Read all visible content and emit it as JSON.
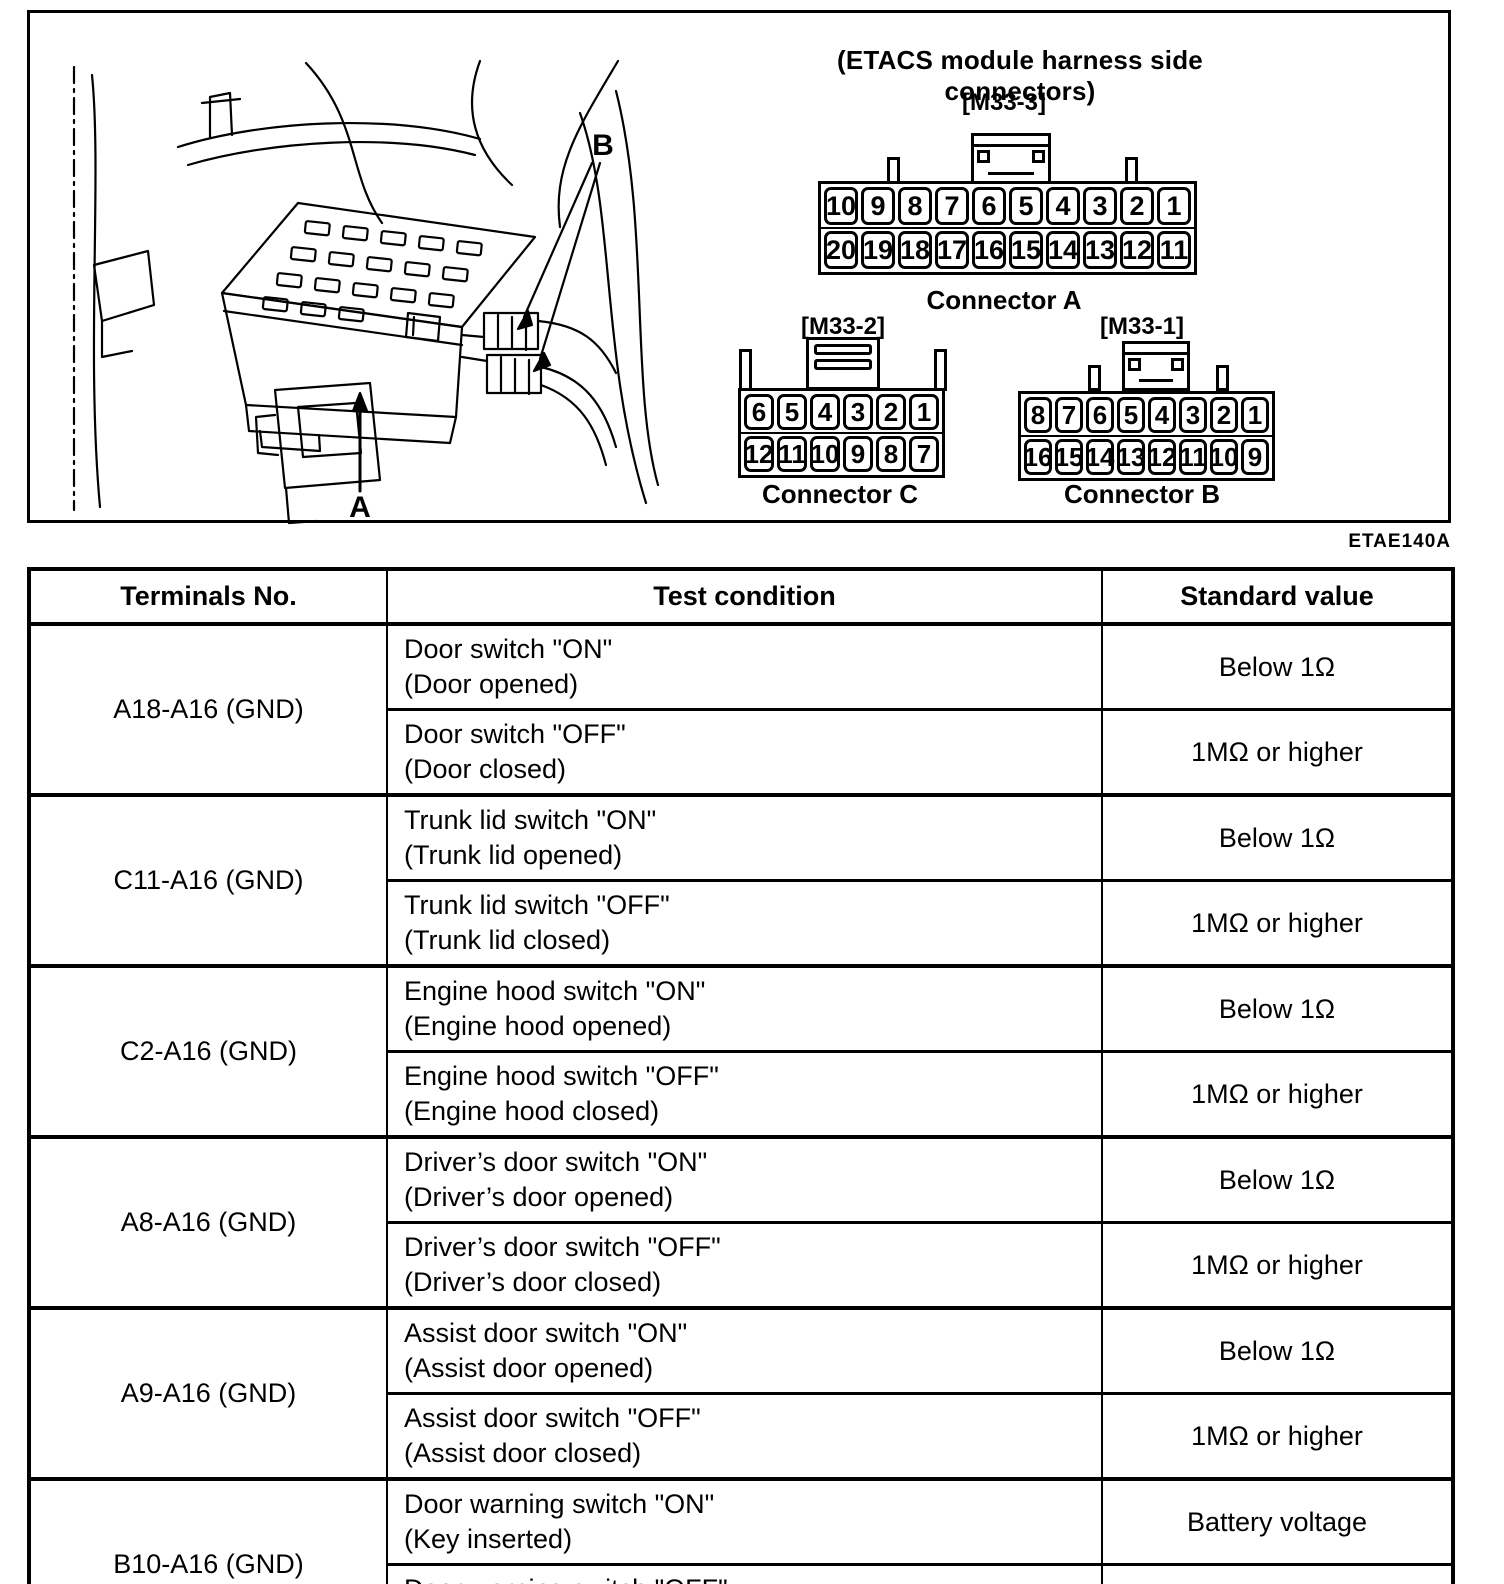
{
  "diagram": {
    "caption": "(ETACS module harness side connectors)",
    "figure_code": "ETAE140A",
    "labels": {
      "a": "A",
      "b": "B"
    },
    "connectors": [
      {
        "id": "a",
        "ref": "[M33-3]",
        "name": "Connector A",
        "row1": [
          "10",
          "9",
          "8",
          "7",
          "6",
          "5",
          "4",
          "3",
          "2",
          "1"
        ],
        "row2": [
          "20",
          "19",
          "18",
          "17",
          "16",
          "15",
          "14",
          "13",
          "12",
          "11"
        ]
      },
      {
        "id": "c",
        "ref": "[M33-2]",
        "name": "Connector C",
        "row1": [
          "6",
          "5",
          "4",
          "3",
          "2",
          "1"
        ],
        "row2": [
          "12",
          "11",
          "10",
          "9",
          "8",
          "7"
        ]
      },
      {
        "id": "b",
        "ref": "[M33-1]",
        "name": "Connector B",
        "row1": [
          "8",
          "7",
          "6",
          "5",
          "4",
          "3",
          "2",
          "1"
        ],
        "row2": [
          "16",
          "15",
          "14",
          "13",
          "12",
          "11",
          "10",
          "9"
        ]
      }
    ]
  },
  "table": {
    "headers": [
      "Terminals No.",
      "Test condition",
      "Standard value"
    ],
    "groups": [
      {
        "terminal": "A18-A16 (GND)",
        "rows": [
          {
            "condition": "Door switch \"ON\"",
            "detail": "(Door opened)",
            "value": "Below 1Ω"
          },
          {
            "condition": "Door switch \"OFF\"",
            "detail": "(Door closed)",
            "value": "1MΩ or higher"
          }
        ]
      },
      {
        "terminal": "C11-A16 (GND)",
        "rows": [
          {
            "condition": "Trunk lid switch \"ON\"",
            "detail": "(Trunk lid opened)",
            "value": "Below 1Ω"
          },
          {
            "condition": "Trunk lid switch \"OFF\"",
            "detail": "(Trunk lid closed)",
            "value": "1MΩ or higher"
          }
        ]
      },
      {
        "terminal": "C2-A16 (GND)",
        "rows": [
          {
            "condition": "Engine hood switch \"ON\"",
            "detail": "(Engine hood opened)",
            "value": "Below 1Ω"
          },
          {
            "condition": "Engine hood switch \"OFF\"",
            "detail": "(Engine hood closed)",
            "value": "1MΩ or higher"
          }
        ]
      },
      {
        "terminal": "A8-A16 (GND)",
        "rows": [
          {
            "condition": "Driver’s door switch \"ON\"",
            "detail": "(Driver’s door opened)",
            "value": "Below 1Ω"
          },
          {
            "condition": "Driver’s door switch \"OFF\"",
            "detail": "(Driver’s door closed)",
            "value": "1MΩ or higher"
          }
        ]
      },
      {
        "terminal": "A9-A16 (GND)",
        "rows": [
          {
            "condition": "Assist door switch \"ON\"",
            "detail": "(Assist door opened)",
            "value": "Below 1Ω"
          },
          {
            "condition": "Assist door switch \"OFF\"",
            "detail": "(Assist door closed)",
            "value": "1MΩ or higher"
          }
        ]
      },
      {
        "terminal": "B10-A16 (GND)",
        "rows": [
          {
            "condition": "Door warning switch \"ON\"",
            "detail": "(Key inserted)",
            "value": "Battery voltage"
          },
          {
            "condition": "Door warning switch \"OFF\"",
            "detail": "(Key removed)",
            "value": "Below 1V"
          }
        ]
      }
    ]
  }
}
